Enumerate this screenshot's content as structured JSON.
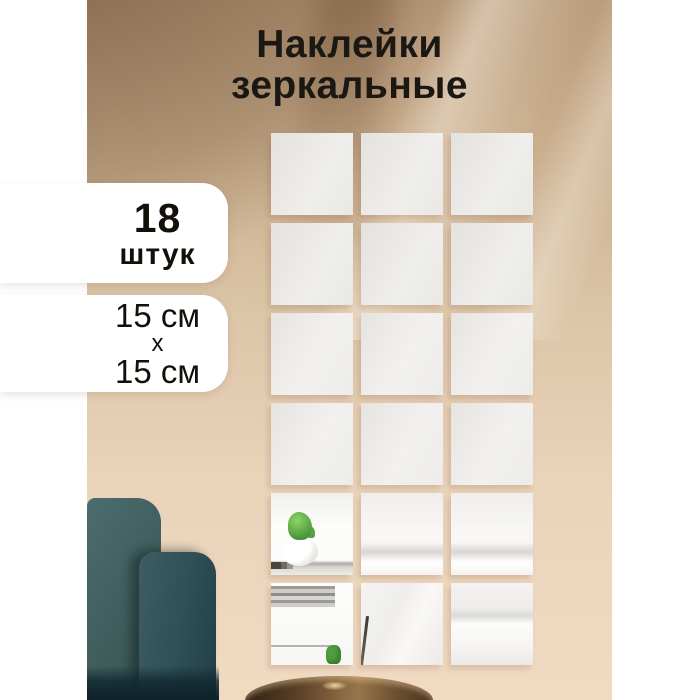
{
  "title": {
    "line1": "Наклейки",
    "line2": "зеркальные"
  },
  "badges": {
    "count": {
      "number": "18",
      "unit": "штук"
    },
    "size": {
      "width_label": "15 см",
      "separator": "х",
      "height_label": "15 см"
    }
  },
  "grid": {
    "columns": 3,
    "rows": 6,
    "total_tiles": 18,
    "reflections": {
      "r5c1": "cactus-pot",
      "r5c2": "duvet",
      "r5c3": "duvet",
      "r6c1": "books-cactus",
      "r6c2": "stem-pillow",
      "r6c3": "duvet-crease"
    }
  },
  "scene": {
    "armchair": "dark-teal-armchair",
    "side_table": "bronze-side-table",
    "mirror": "mirror-tile-sticker",
    "reflection_objects": [
      "cactus-in-white-pot",
      "stacked-books",
      "white-bedding"
    ]
  },
  "colors": {
    "canvas_white": "#ffffff",
    "wall_top_brown": "#b4946f",
    "wall_mid_beige": "#e0c9ac",
    "wall_bottom_pink": "#f0dac2",
    "mirror_light": "#f2f1ef",
    "mirror_dark": "#e4e2df",
    "chair_teal": "#375860",
    "chair_teal_dark": "#223f48",
    "table_bronze": "#8a6a42",
    "badge_bg": "#ffffff",
    "text_dark": "#1b1814"
  }
}
